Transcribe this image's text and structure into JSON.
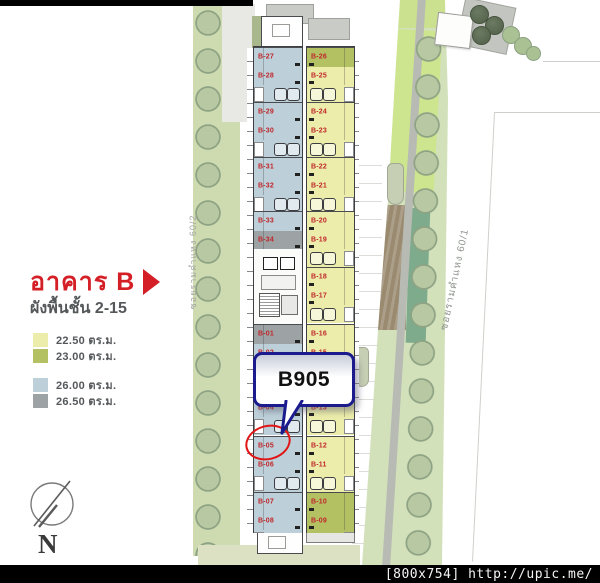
{
  "title": {
    "building": "อาคาร B",
    "floors": "ผังพื้นชั้น 2-15"
  },
  "legend": {
    "items": [
      {
        "area_label": "22.50 ตร.ม.",
        "color": "#ecedaa"
      },
      {
        "area_label": "23.00 ตร.ม.",
        "color": "#b4c163"
      },
      {
        "area_label": "26.00 ตร.ม.",
        "color": "#bdd0d9"
      },
      {
        "area_label": "26.50 ตร.ม.",
        "color": "#9da3a4"
      }
    ]
  },
  "roads": {
    "left": "ซอยรามคำแหง 60/2",
    "right": "ซอยรามคำแหง 60/1"
  },
  "callout": {
    "label": "B905",
    "target_unit": "B-05",
    "border_color": "#1b1b8e",
    "highlight_color": "#e11515"
  },
  "compass": {
    "label": "N"
  },
  "watermark": {
    "text": "[800x754] http://upic.me/"
  },
  "building": {
    "unit_label_color": "#c0262b",
    "left_units": [
      {
        "label": "B-27",
        "area": "26.00"
      },
      {
        "label": "B-28",
        "area": "26.00"
      },
      {
        "label": "B-29",
        "area": "26.00"
      },
      {
        "label": "B-30",
        "area": "26.00"
      },
      {
        "label": "B-31",
        "area": "26.00"
      },
      {
        "label": "B-32",
        "area": "26.00"
      },
      {
        "label": "B-33",
        "area": "26.00"
      },
      {
        "label": "B-34",
        "area": "26.50"
      },
      {
        "label": "B-01",
        "area": "26.50"
      },
      {
        "label": "B-02",
        "area": "26.00"
      },
      {
        "label": "B-03",
        "area": "26.00"
      },
      {
        "label": "B-04",
        "area": "26.00"
      },
      {
        "label": "B-05",
        "area": "26.00",
        "highlighted": true
      },
      {
        "label": "B-06",
        "area": "26.00"
      },
      {
        "label": "B-07",
        "area": "26.00"
      },
      {
        "label": "B-08",
        "area": "26.00"
      }
    ],
    "right_units": [
      {
        "label": "B-26",
        "area": "23.00"
      },
      {
        "label": "B-25",
        "area": "22.50"
      },
      {
        "label": "B-24",
        "area": "22.50"
      },
      {
        "label": "B-23",
        "area": "22.50"
      },
      {
        "label": "B-22",
        "area": "22.50"
      },
      {
        "label": "B-21",
        "area": "22.50"
      },
      {
        "label": "B-20",
        "area": "22.50"
      },
      {
        "label": "B-19",
        "area": "22.50"
      },
      {
        "label": "B-18",
        "area": "22.50"
      },
      {
        "label": "B-17",
        "area": "22.50"
      },
      {
        "label": "B-16",
        "area": "22.50"
      },
      {
        "label": "B-15",
        "area": "22.50"
      },
      {
        "label": "B-14",
        "area": "22.50"
      },
      {
        "label": "B-13",
        "area": "22.50"
      },
      {
        "label": "B-12",
        "area": "22.50"
      },
      {
        "label": "B-11",
        "area": "22.50"
      },
      {
        "label": "B-10",
        "area": "23.00"
      },
      {
        "label": "B-09",
        "area": "23.00"
      }
    ]
  }
}
